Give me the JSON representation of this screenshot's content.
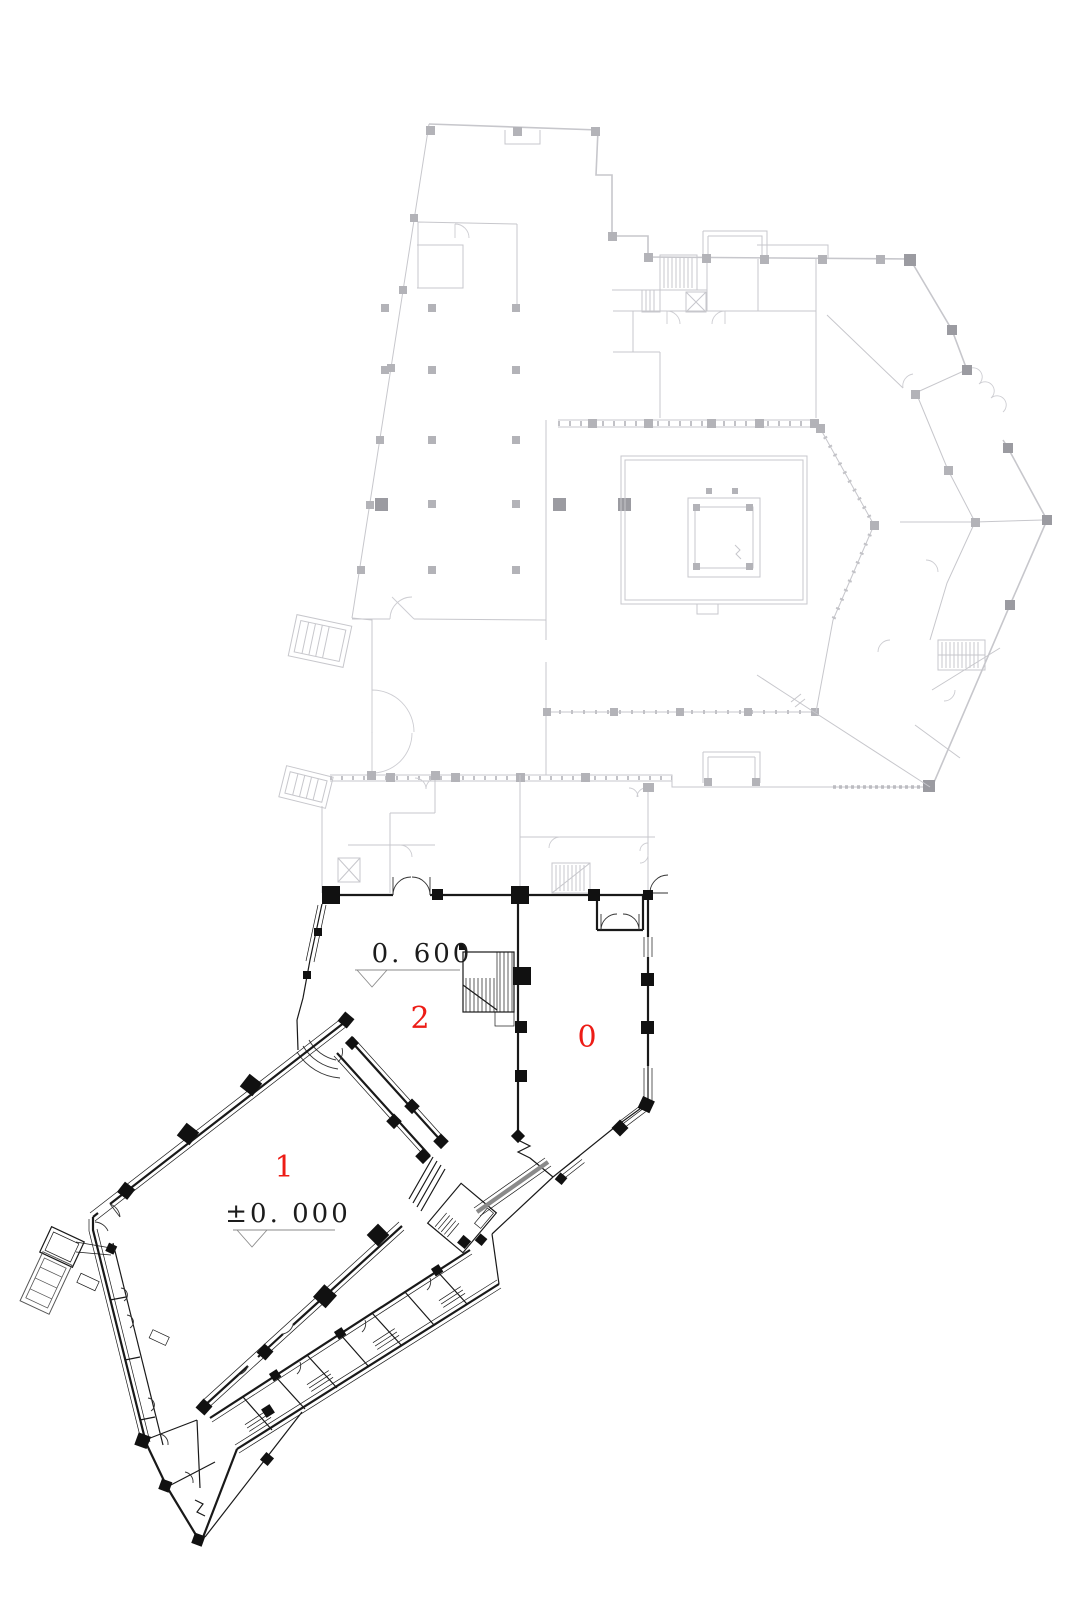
{
  "drawing": {
    "type": "architectural-floor-plan",
    "room_labels": {
      "room1": "1",
      "room2": "2",
      "room0": "0"
    },
    "elevation_markers": {
      "upper": {
        "label": "0. 600"
      },
      "lower": {
        "label": "±0. 000"
      }
    },
    "colors": {
      "room_number_red": "#ed1c16",
      "dark_wall": "#191919",
      "light_wall": "#c7c7cc",
      "ramp_gray": "#8a8a8a",
      "background": "#ffffff"
    }
  }
}
